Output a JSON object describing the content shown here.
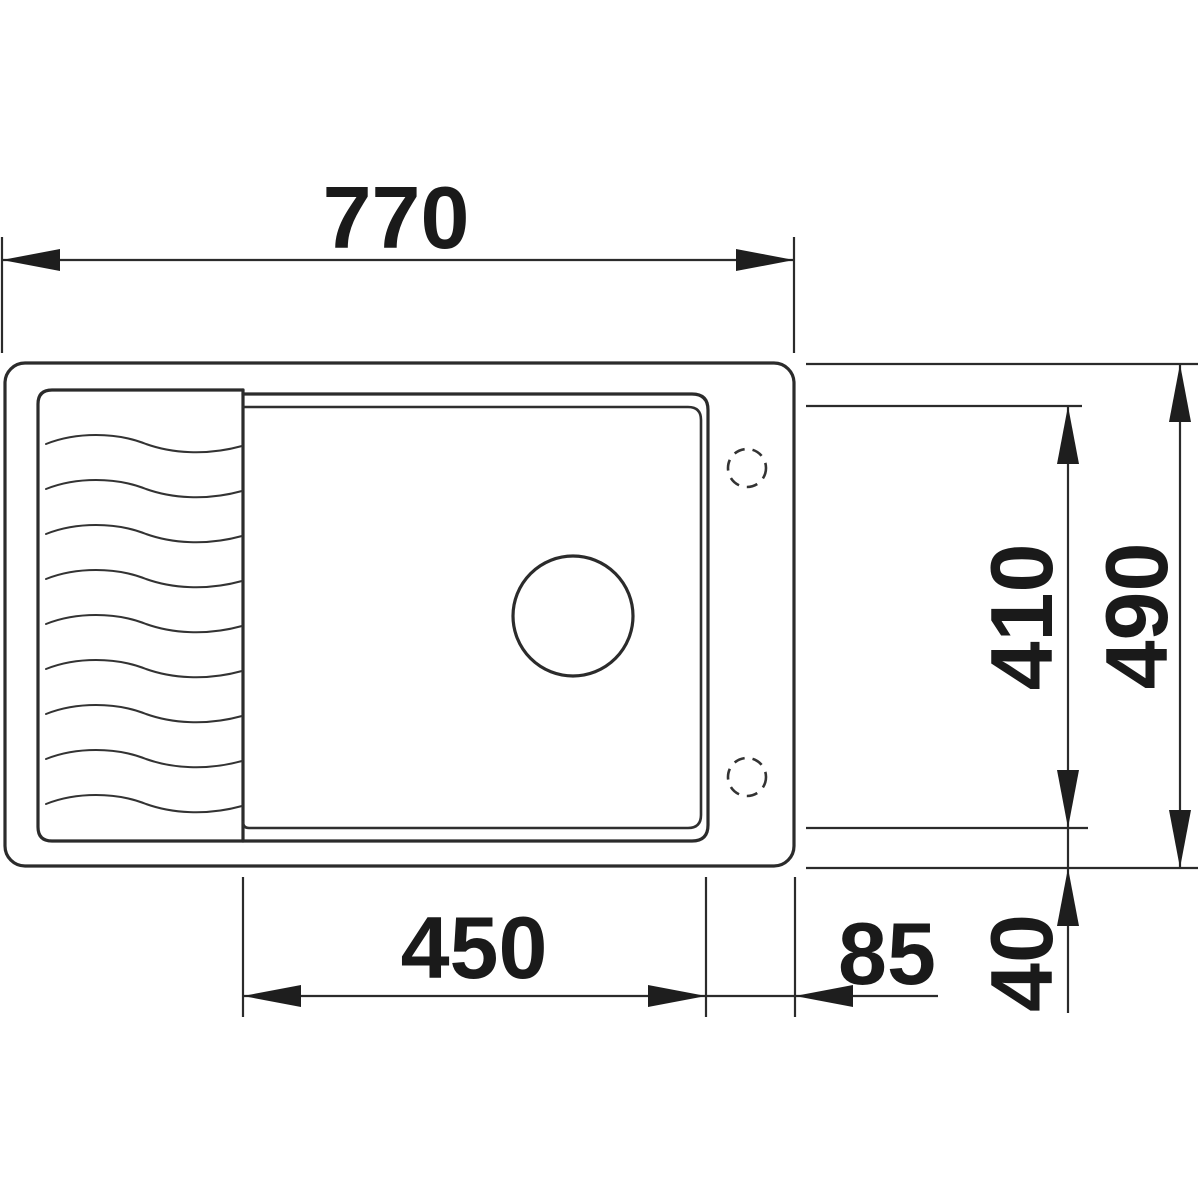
{
  "drawing": {
    "type": "technical-dimension-drawing",
    "subject": "kitchen sink top view with drainer area, basin, drain hole and two tap holes",
    "background_color": "#ffffff",
    "line_color": "#2b2b2b",
    "text_color": "#1a1a1a",
    "dimensions": {
      "overall_width": "770",
      "basin_width": "450",
      "right_rim_width": "85",
      "bottom_rim_depth": "40",
      "basin_depth": "410",
      "overall_depth": "490"
    }
  }
}
